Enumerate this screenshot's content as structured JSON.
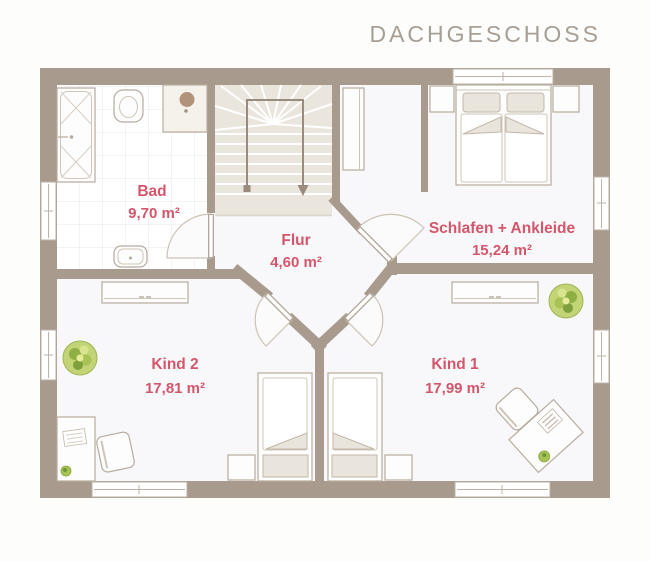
{
  "title": "DACHGESCHOSS",
  "colors": {
    "wall": "#a89b8d",
    "room_label": "#d4566b",
    "title_text": "#a79e94",
    "stairs_fill": "#eae5dd",
    "bedding_beige": "#eae5dc",
    "plant_green": "#a9c255",
    "shower_head": "#b09379"
  },
  "rooms": {
    "bad": {
      "name": "Bad",
      "area": "9,70 m²"
    },
    "flur": {
      "name": "Flur",
      "area": "4,60 m²"
    },
    "schlafen": {
      "name": "Schlafen + Ankleide",
      "area": "15,24 m²"
    },
    "kind2": {
      "name": "Kind 2",
      "area": "17,81 m²"
    },
    "kind1": {
      "name": "Kind 1",
      "area": "17,99 m²"
    }
  }
}
